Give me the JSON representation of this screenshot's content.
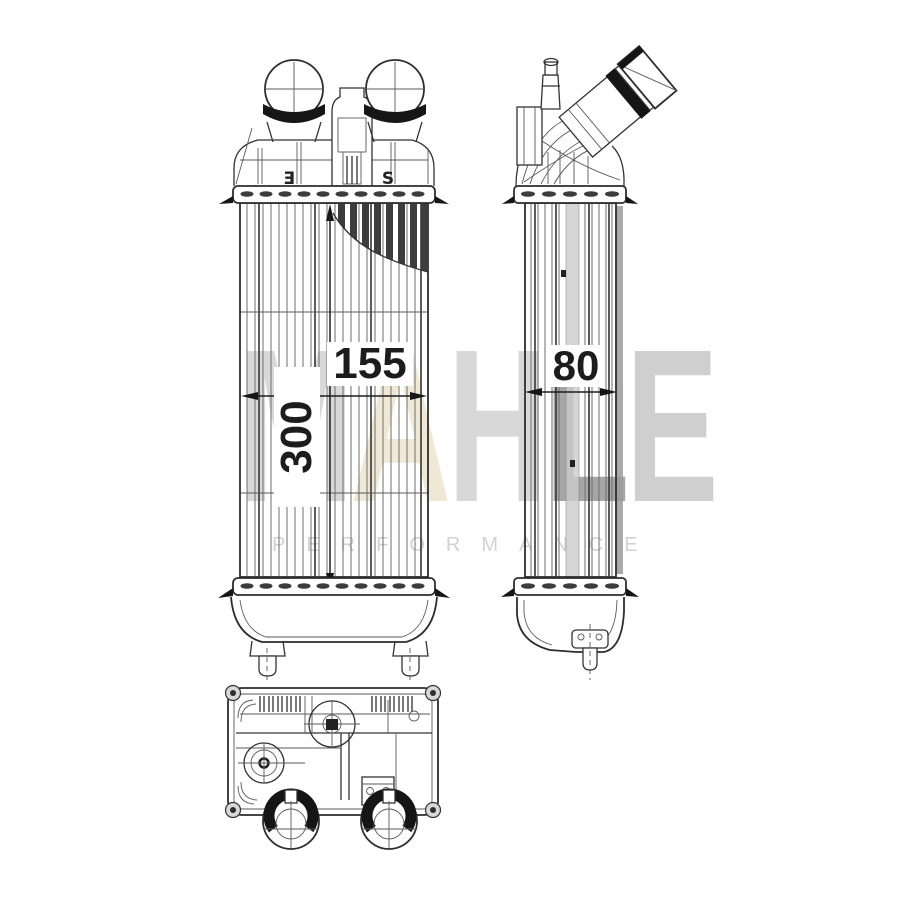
{
  "page": {
    "background": "#ffffff"
  },
  "drawing": {
    "subject": "intercooler-technical-drawing",
    "line_color": "#333333",
    "views": {
      "front": "front-view",
      "side": "side-view",
      "bottom": "bottom-view"
    }
  },
  "dimensions": {
    "core_width_mm": "155",
    "core_height_mm": "300",
    "core_depth_mm": "80"
  },
  "markings": {
    "left_port": "Ǝ",
    "right_port": "S"
  },
  "watermark": {
    "letters": [
      {
        "char": "M",
        "color": "#d8d8d8"
      },
      {
        "char": "A",
        "color": "#eee8d5"
      },
      {
        "char": "H",
        "color": "#d8d8d8"
      },
      {
        "char": "L",
        "color": "#a6a6a6"
      },
      {
        "char": "E",
        "color": "#cfcfcf"
      }
    ],
    "subtitle": "PERFORMANCE",
    "subtitle_color": "#d2d2d2"
  }
}
